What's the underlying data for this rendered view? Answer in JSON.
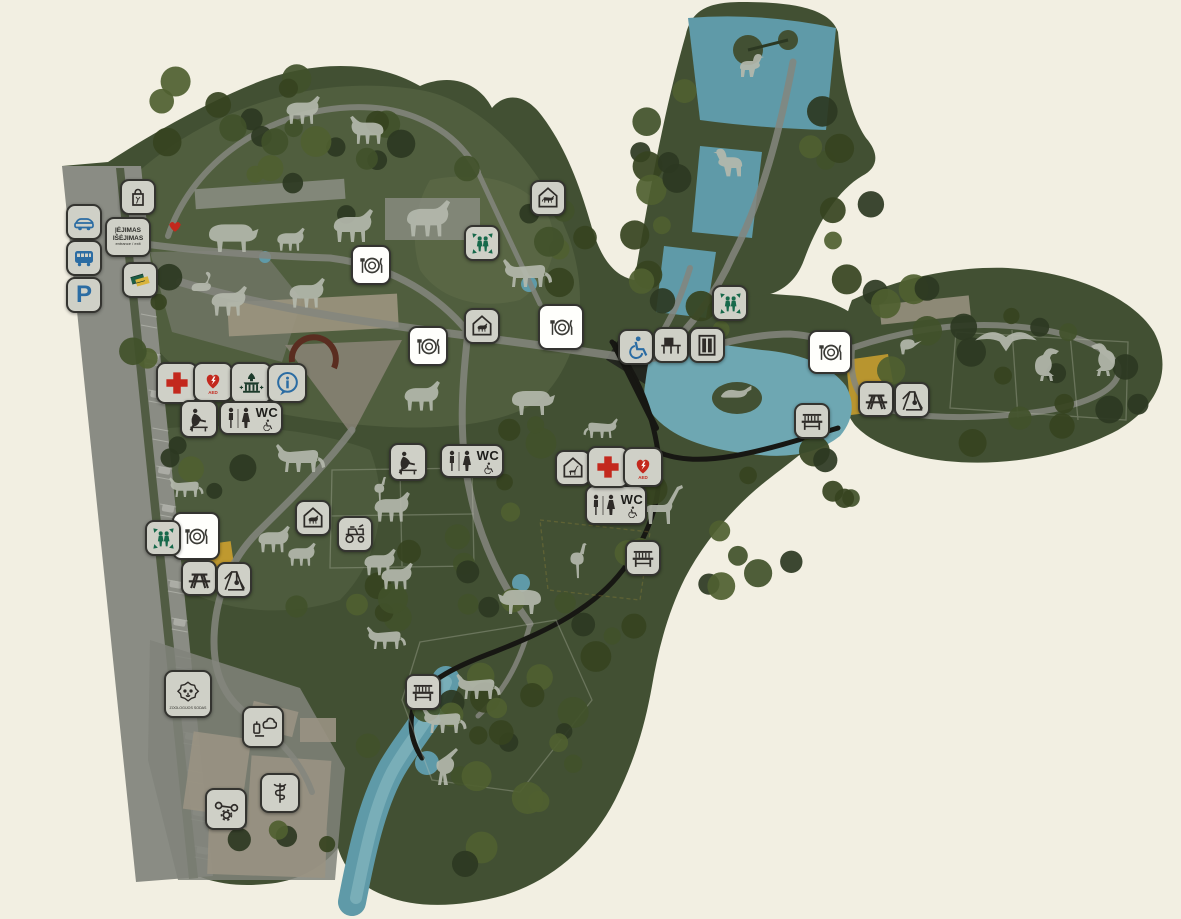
{
  "map": {
    "title": "zoo-park-map",
    "colors": {
      "background": "#f2efe2",
      "map_green": "#425033",
      "light_zone": "#5e6c49",
      "tree_dark": "#2c3822",
      "water": "#5f9aa8",
      "path_gray": "#84867e",
      "trail_black": "#171713",
      "badge_gray": "#cfd0c7",
      "badge_white": "#fffffc",
      "accent_blue": "#2b6ca3",
      "accent_green": "#17694b",
      "accent_red": "#c3281d",
      "building_gold": "#bf992f",
      "building_tan": "#9a9383"
    },
    "labels": {
      "wc": "WC",
      "parking": "P",
      "aed": "AED",
      "zoo_logo": "ZOOLOGIJOS SODAS"
    },
    "entrance_sign": {
      "line1": "ĮĖJIMAS",
      "line2": "IŠĖJIMAS",
      "line3": "entrance / exit"
    },
    "markers": [
      {
        "type": "car-access",
        "x": 84,
        "y": 222
      },
      {
        "type": "bus-access",
        "x": 84,
        "y": 258
      },
      {
        "type": "parking",
        "x": 84,
        "y": 295
      },
      {
        "type": "gift-shop",
        "x": 138,
        "y": 197
      },
      {
        "type": "entrance-sign",
        "x": 128,
        "y": 237,
        "w": 46,
        "h": 40
      },
      {
        "type": "ticket-office",
        "x": 140,
        "y": 280
      },
      {
        "type": "entrance-marker",
        "x": 175,
        "y": 228,
        "w": 20,
        "h": 20
      },
      {
        "type": "restaurant",
        "x": 371,
        "y": 265,
        "w": 40
      },
      {
        "type": "restaurant",
        "x": 428,
        "y": 346,
        "w": 40
      },
      {
        "type": "restaurant",
        "x": 561,
        "y": 327,
        "w": 46
      },
      {
        "type": "restaurant",
        "x": 830,
        "y": 352,
        "w": 44
      },
      {
        "type": "restaurant",
        "x": 196,
        "y": 536,
        "w": 48
      },
      {
        "type": "meeting-point",
        "x": 482,
        "y": 243
      },
      {
        "type": "meeting-point",
        "x": 730,
        "y": 303
      },
      {
        "type": "meeting-point",
        "x": 163,
        "y": 538
      },
      {
        "type": "first-aid",
        "x": 177,
        "y": 383,
        "w": 42
      },
      {
        "type": "aed",
        "x": 213,
        "y": 382,
        "w": 40
      },
      {
        "type": "monument",
        "x": 251,
        "y": 383,
        "w": 42
      },
      {
        "type": "information",
        "x": 287,
        "y": 383,
        "w": 40
      },
      {
        "type": "baby-care",
        "x": 199,
        "y": 419,
        "w": 38
      },
      {
        "type": "wc",
        "x": 251,
        "y": 418,
        "w": 64,
        "h": 34
      },
      {
        "type": "baby-care",
        "x": 408,
        "y": 462,
        "w": 38
      },
      {
        "type": "wc",
        "x": 472,
        "y": 461,
        "w": 64,
        "h": 34
      },
      {
        "type": "wc",
        "x": 616,
        "y": 505,
        "w": 62,
        "h": 40
      },
      {
        "type": "cat-house",
        "x": 548,
        "y": 198
      },
      {
        "type": "animal-house",
        "x": 482,
        "y": 326
      },
      {
        "type": "giraffe-house",
        "x": 573,
        "y": 468
      },
      {
        "type": "farm-house",
        "x": 313,
        "y": 518
      },
      {
        "type": "wheelchair-access",
        "x": 636,
        "y": 347
      },
      {
        "type": "feeding-point",
        "x": 671,
        "y": 345
      },
      {
        "type": "elevator",
        "x": 707,
        "y": 345
      },
      {
        "type": "first-aid",
        "x": 608,
        "y": 467,
        "w": 42
      },
      {
        "type": "aed",
        "x": 643,
        "y": 467,
        "w": 40
      },
      {
        "type": "picnic-area",
        "x": 199,
        "y": 578
      },
      {
        "type": "playground",
        "x": 234,
        "y": 580
      },
      {
        "type": "picnic-area",
        "x": 876,
        "y": 399
      },
      {
        "type": "playground",
        "x": 912,
        "y": 400
      },
      {
        "type": "bench",
        "x": 812,
        "y": 421
      },
      {
        "type": "bench",
        "x": 643,
        "y": 558
      },
      {
        "type": "bench",
        "x": 423,
        "y": 692
      },
      {
        "type": "safari-ride",
        "x": 355,
        "y": 534
      },
      {
        "type": "zoo-logo",
        "x": 188,
        "y": 694,
        "w": 48,
        "h": 48
      },
      {
        "type": "kitchen",
        "x": 263,
        "y": 727,
        "w": 42
      },
      {
        "type": "veterinary",
        "x": 280,
        "y": 793,
        "w": 40
      },
      {
        "type": "maintenance",
        "x": 226,
        "y": 809,
        "w": 42
      }
    ],
    "animals": [
      {
        "kind": "llama",
        "x": 302,
        "y": 112,
        "s": 0.85
      },
      {
        "kind": "deer",
        "x": 368,
        "y": 132,
        "s": 0.85,
        "flip": true
      },
      {
        "kind": "bison",
        "x": 232,
        "y": 237,
        "s": 1.15
      },
      {
        "kind": "goat",
        "x": 290,
        "y": 241,
        "s": 0.7
      },
      {
        "kind": "camel",
        "x": 352,
        "y": 228,
        "s": 1.0
      },
      {
        "kind": "musk-ox",
        "x": 427,
        "y": 221,
        "s": 1.1
      },
      {
        "kind": "swan",
        "x": 206,
        "y": 287,
        "s": 0.8
      },
      {
        "kind": "anteater",
        "x": 228,
        "y": 303,
        "s": 0.9
      },
      {
        "kind": "horse",
        "x": 306,
        "y": 295,
        "s": 0.9
      },
      {
        "kind": "tiger",
        "x": 527,
        "y": 277,
        "s": 1.0,
        "flip": true
      },
      {
        "kind": "lion",
        "x": 300,
        "y": 462,
        "s": 1.0,
        "flip": true
      },
      {
        "kind": "fox",
        "x": 186,
        "y": 490,
        "s": 0.7,
        "flip": true
      },
      {
        "kind": "deer",
        "x": 421,
        "y": 398,
        "s": 0.9
      },
      {
        "kind": "elk",
        "x": 532,
        "y": 402,
        "s": 1.0
      },
      {
        "kind": "wildcat",
        "x": 601,
        "y": 431,
        "s": 0.7
      },
      {
        "kind": "heron",
        "x": 380,
        "y": 490,
        "s": 0.7
      },
      {
        "kind": "giraffe",
        "x": 661,
        "y": 504,
        "s": 1.0
      },
      {
        "kind": "ostrich",
        "x": 578,
        "y": 561,
        "s": 0.95
      },
      {
        "kind": "zebra",
        "x": 391,
        "y": 509,
        "s": 0.9
      },
      {
        "kind": "pony",
        "x": 273,
        "y": 541,
        "s": 0.8
      },
      {
        "kind": "sheep",
        "x": 301,
        "y": 556,
        "s": 0.7
      },
      {
        "kind": "cow",
        "x": 379,
        "y": 564,
        "s": 0.8
      },
      {
        "kind": "donkey",
        "x": 396,
        "y": 578,
        "s": 0.8
      },
      {
        "kind": "rhino",
        "x": 521,
        "y": 601,
        "s": 1.0,
        "flip": true
      },
      {
        "kind": "fox",
        "x": 386,
        "y": 641,
        "s": 0.8,
        "flip": true
      },
      {
        "kind": "lynx",
        "x": 478,
        "y": 690,
        "s": 0.9,
        "flip": true
      },
      {
        "kind": "lynx",
        "x": 444,
        "y": 724,
        "s": 0.9,
        "flip": true
      },
      {
        "kind": "wolf",
        "x": 450,
        "y": 767,
        "s": 1.0
      },
      {
        "kind": "seal",
        "x": 737,
        "y": 396,
        "s": 0.8
      },
      {
        "kind": "duck",
        "x": 756,
        "y": 70,
        "s": 1.0
      },
      {
        "kind": "pelican",
        "x": 723,
        "y": 168,
        "s": 1.2,
        "flip": true
      },
      {
        "kind": "eagle",
        "x": 1006,
        "y": 347,
        "s": 1.1
      },
      {
        "kind": "vulture",
        "x": 1051,
        "y": 362,
        "s": 1.0
      },
      {
        "kind": "condor",
        "x": 1099,
        "y": 357,
        "s": 1.0,
        "flip": true
      },
      {
        "kind": "perched-bird",
        "x": 913,
        "y": 344,
        "s": 0.8
      }
    ]
  }
}
